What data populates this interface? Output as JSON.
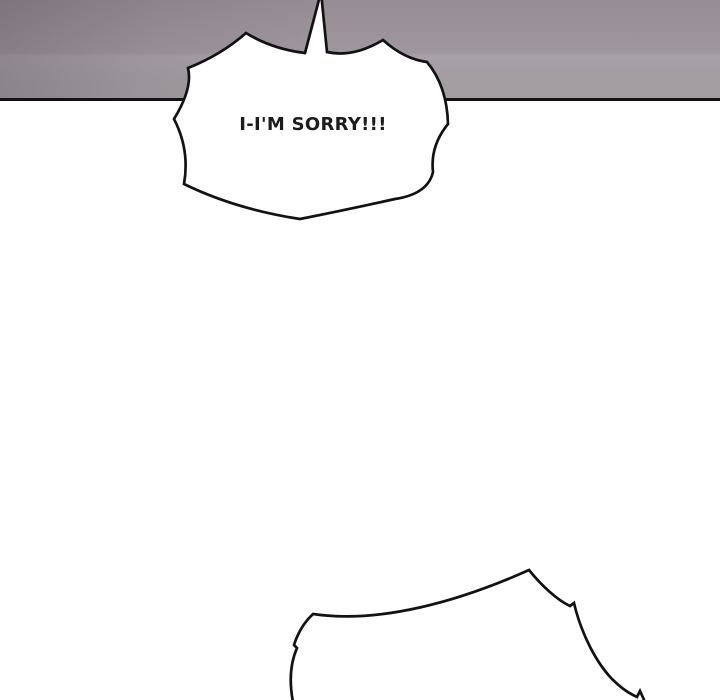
{
  "panel": {
    "background_color": "#ffffff",
    "ink_color": "#141114",
    "wall": {
      "base_color": "#a09aa0",
      "shadow_color": "#8f878e",
      "highlight_color": "#a8a1a7",
      "edge_line_color": "#141114"
    },
    "speech_bubble": {
      "text": "I-I'M SORRY!!!",
      "fill_color": "#ffffff",
      "outline_color": "#141114",
      "text_color": "#1c1c1c"
    },
    "bottom_burst": {
      "fill_color": "#ffffff",
      "outline_color": "#141114"
    }
  }
}
